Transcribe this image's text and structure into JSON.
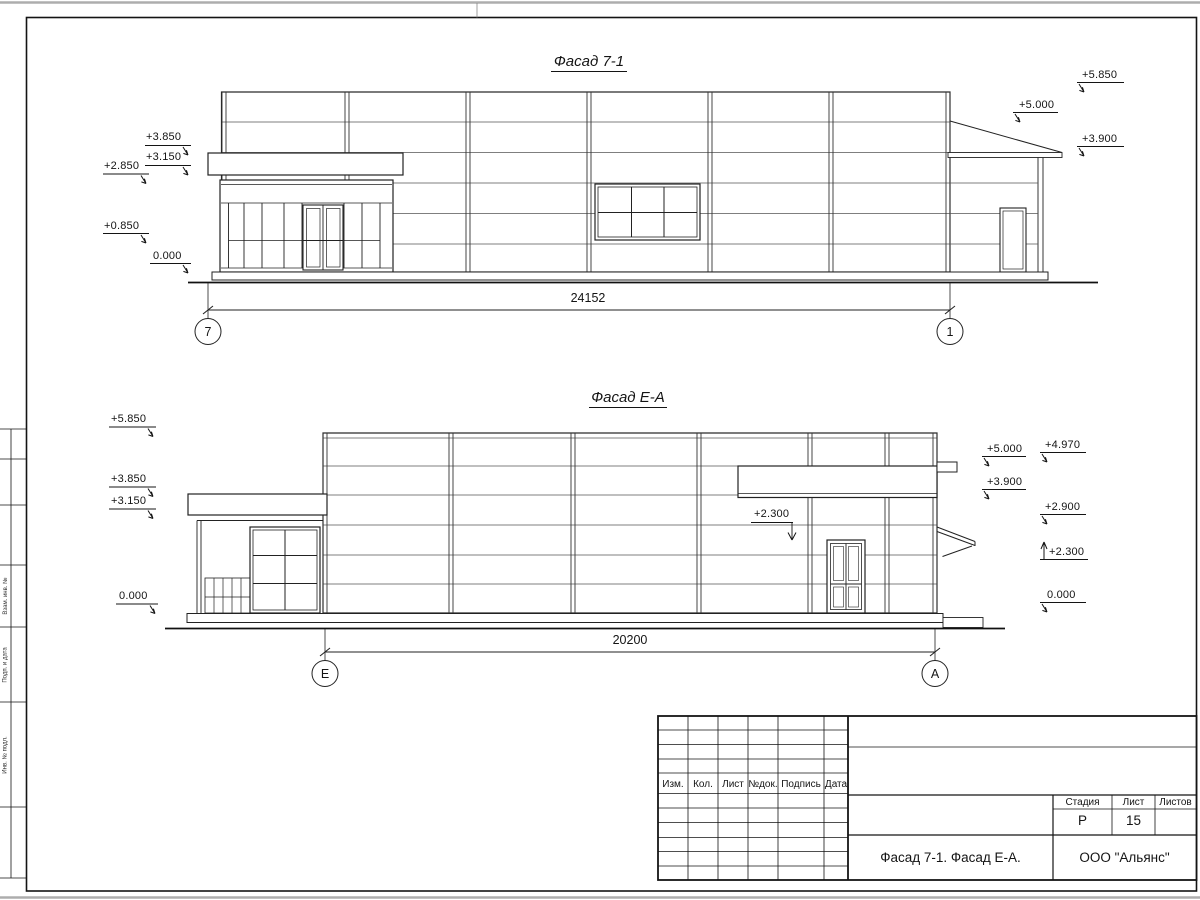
{
  "drawing": {
    "facade1": {
      "title": "Фасад 7-1",
      "dim": "24152",
      "axis_left": "7",
      "axis_right": "1",
      "marks_left": [
        "+3.850",
        "+3.150",
        "+2.850",
        "+0.850",
        "0.000"
      ],
      "marks_right": [
        "+5.850",
        "+5.000",
        "+3.900"
      ]
    },
    "facade2": {
      "title": "Фасад Е-А",
      "dim": "20200",
      "axis_left": "Е",
      "axis_right": "А",
      "marks_left": [
        "+5.850",
        "+3.850",
        "+3.150",
        "0.000"
      ],
      "marks_right": [
        "+5.000",
        "+4.970",
        "+3.900",
        "+2.900",
        "+2.300",
        "0.000"
      ],
      "leader_mark": "+2.300"
    },
    "side_column": {
      "labels": [
        "Взам. инв. №",
        "Подп. и дата",
        "Инв. № подл."
      ]
    },
    "title_block": {
      "columns": [
        "Изм.",
        "Кол.",
        "Лист",
        "№док.",
        "Подпись",
        "Дата"
      ],
      "stage_label": "Стадия",
      "sheet_label": "Лист",
      "sheets_label": "Листов",
      "stage_value": "Р",
      "sheet_value": "15",
      "doc_title": "Фасад 7-1. Фасад Е-А.",
      "company": "ООО \"Альянс\""
    }
  }
}
